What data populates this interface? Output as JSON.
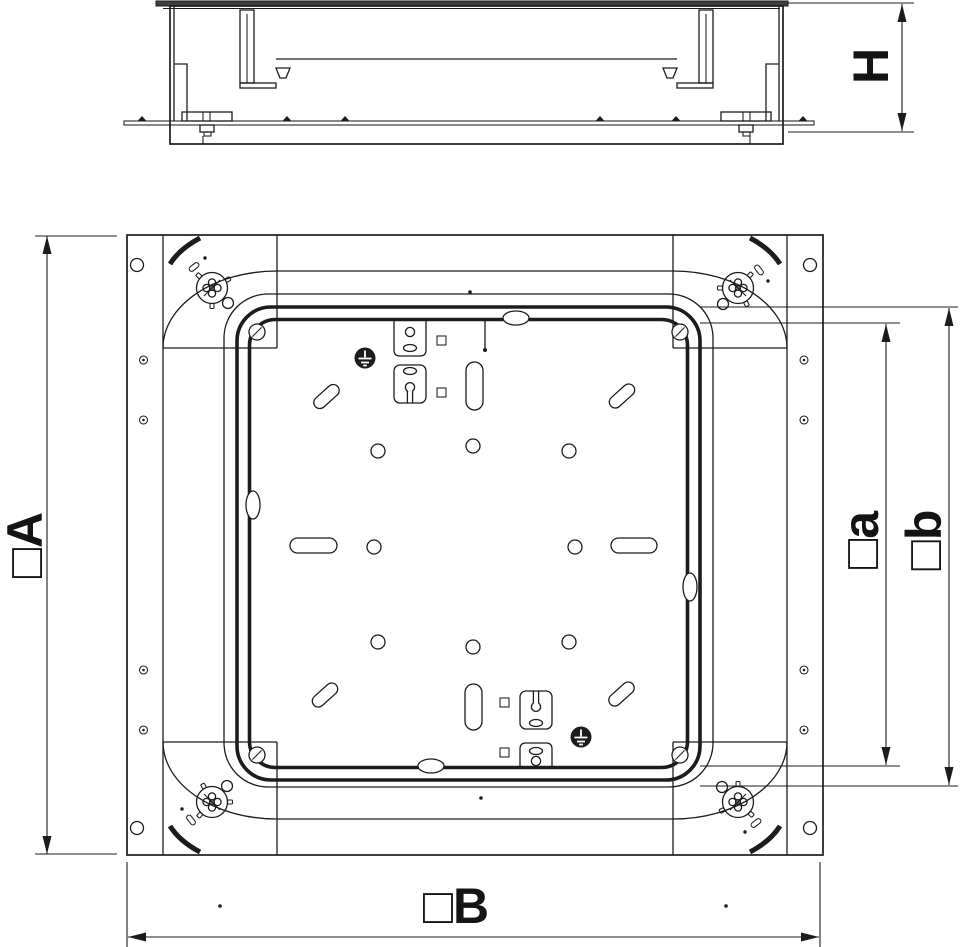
{
  "labels": {
    "dim_A": "□A",
    "dim_B": "□B",
    "dim_a": "□a",
    "dim_b": "□b",
    "dim_H": "H"
  },
  "symbols": {
    "ground": "earth-ground-symbol",
    "leveling_screw": "leveling-screw",
    "corner_screw": "cover-screw",
    "arrowhead": "dimension-arrow"
  },
  "colors": {
    "line": "#1c1c1c",
    "cover_fill": "#3f3f3f",
    "background": "#ffffff"
  }
}
